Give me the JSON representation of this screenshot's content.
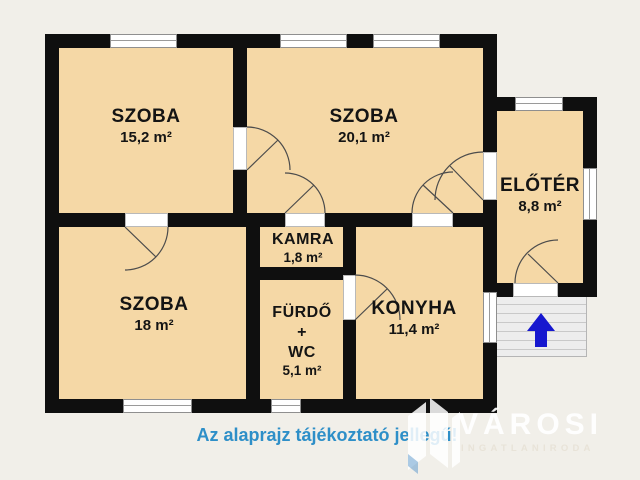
{
  "rooms": {
    "szoba1": {
      "name": "SZOBA",
      "area": "15,2 m²"
    },
    "szoba2": {
      "name": "SZOBA",
      "area": "20,1 m²"
    },
    "eloter": {
      "name": "ELŐTÉR",
      "area": "8,8 m²"
    },
    "szoba3": {
      "name": "SZOBA",
      "area": "18 m²"
    },
    "kamra": {
      "name": "KAMRA",
      "area": "1,8 m²"
    },
    "furdo": {
      "name": "FÜRDŐ",
      "plus": "+",
      "name2": "WC",
      "area": "5,1 m²"
    },
    "konyha": {
      "name": "KONYHA",
      "area": "11,4 m²"
    }
  },
  "footer": {
    "disclaimer": "Az alaprajz tájékoztató jellegű!"
  },
  "brand": {
    "name": "VÁROSI",
    "subtitle": "INGATLANIRODA"
  },
  "icons": {
    "stairs_direction": "up-arrow-icon",
    "brand": "buildings-icon"
  },
  "colors": {
    "wall": "#0f0f0f",
    "room_fill": "#f5d8a6",
    "background": "#f1efe9",
    "disclaimer_blue": "#2e8fc8",
    "arrow_blue": "#1617cf",
    "window_white": "#ffffff"
  }
}
